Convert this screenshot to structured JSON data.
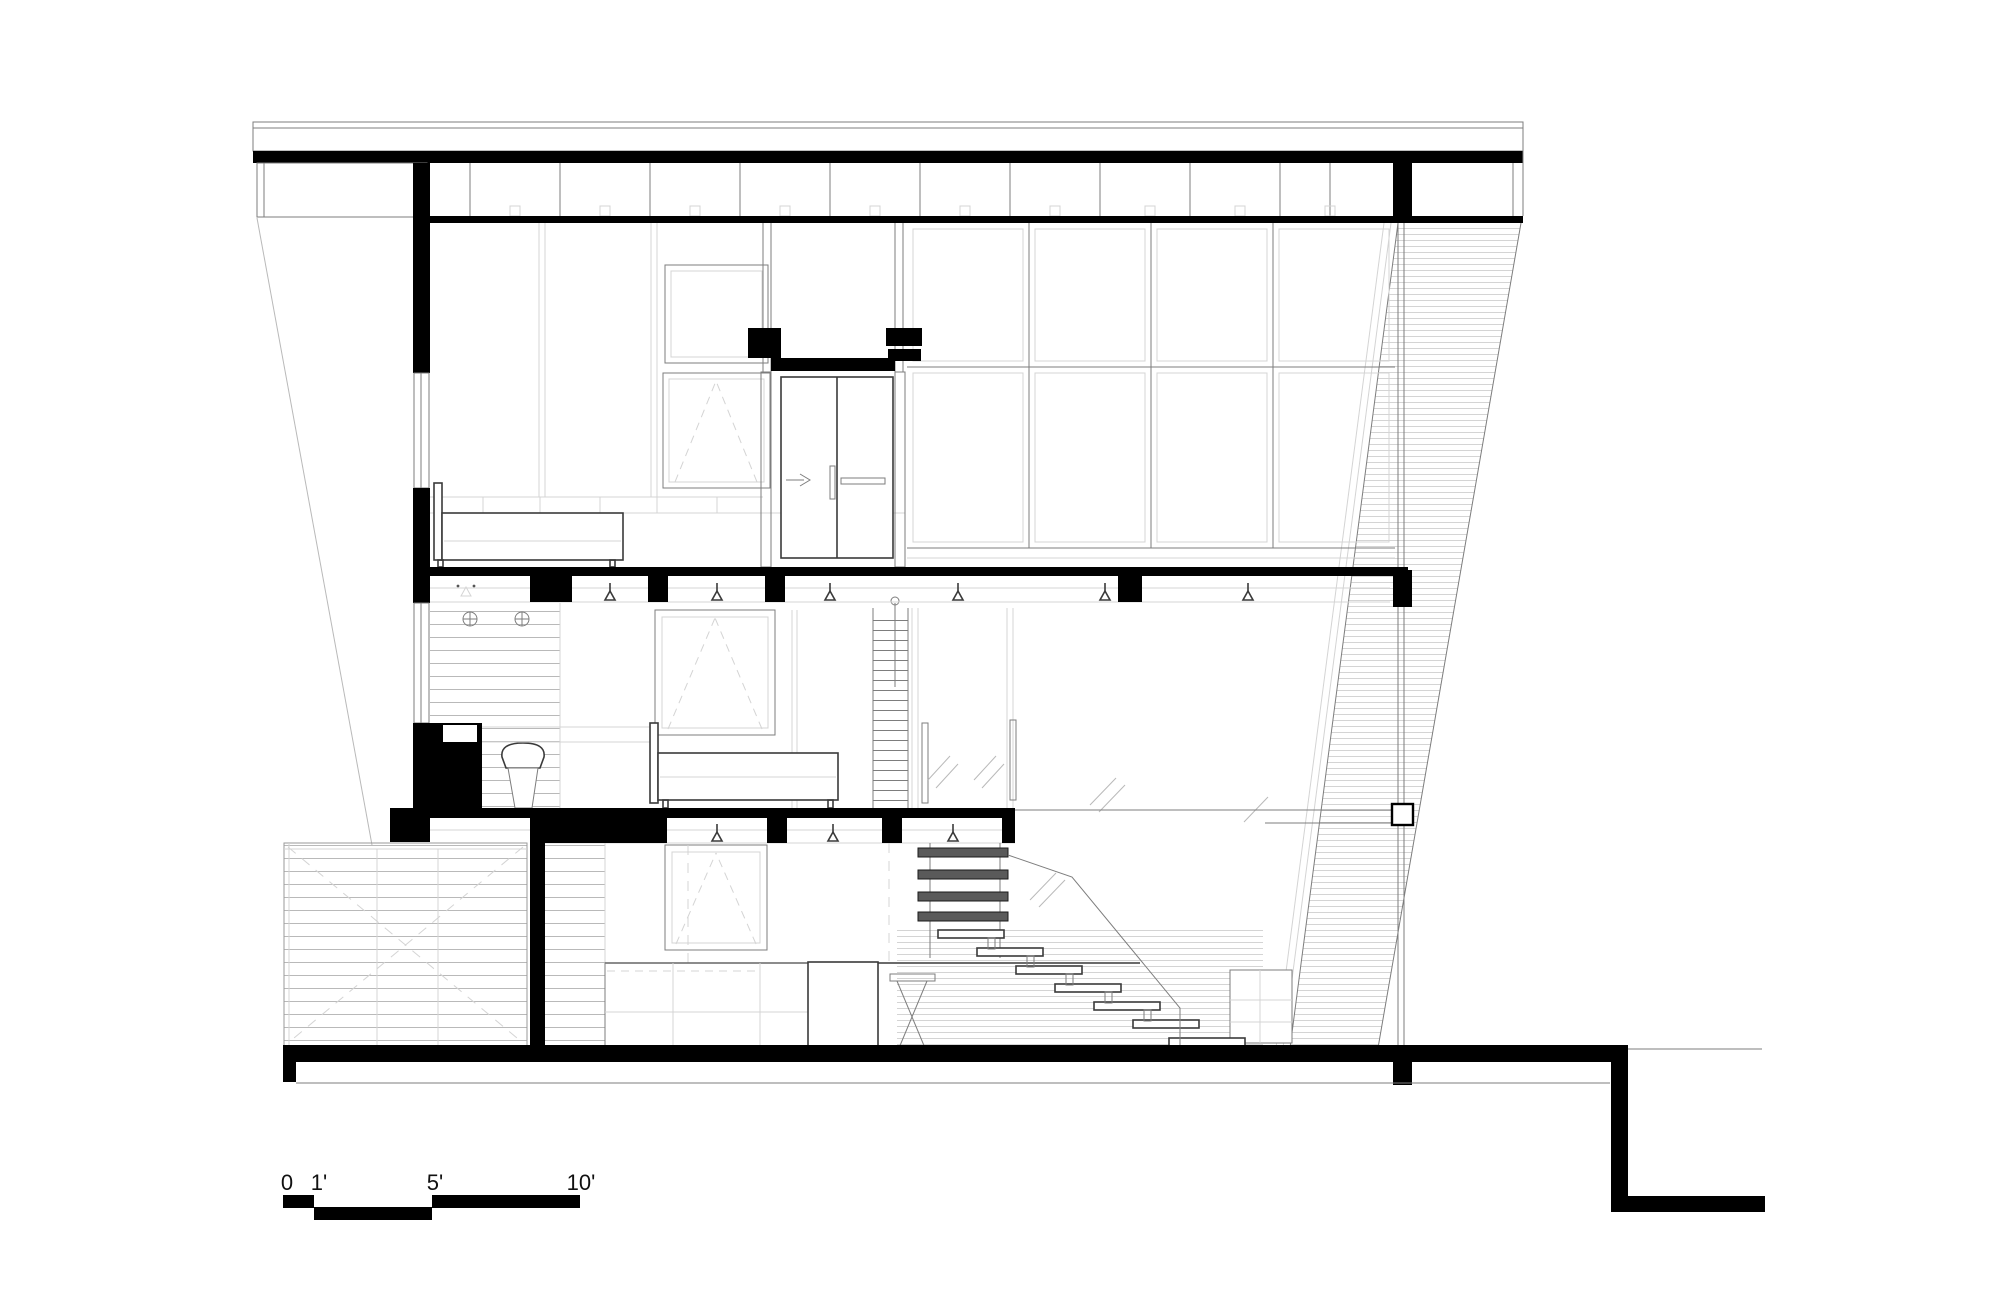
{
  "document": {
    "type": "architectural cross-section drawing",
    "background": "#ffffff"
  },
  "scale_bar": {
    "labels": [
      "0",
      "1'",
      "5'",
      "10'"
    ]
  },
  "colors": {
    "ink": "#000000",
    "line": "#7d7d7d",
    "light": "#b9b9b9",
    "faint": "#d4d4d4",
    "bg": "#ffffff"
  },
  "symbols": {
    "pendant_light": "pendant-light-icon",
    "sprinkler": "sprinkler-icon",
    "shower_valve": "shower-valve-icon",
    "awning_window": "awning-window-opening-symbol",
    "door_swing_arrow": "door-slide-arrow-icon"
  }
}
